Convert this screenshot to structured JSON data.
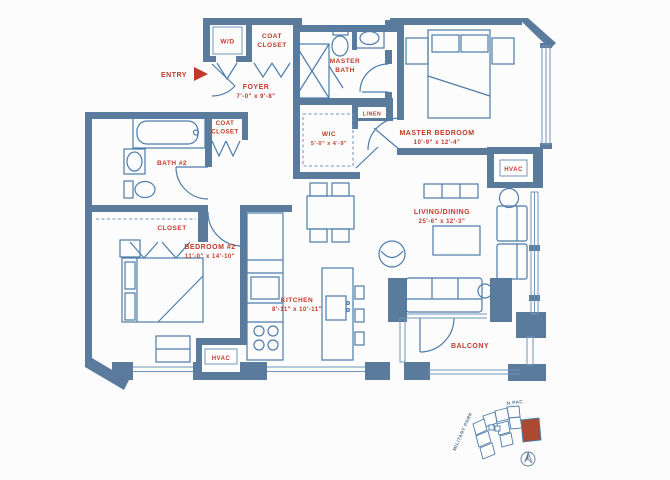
{
  "colors": {
    "wall": "#5b7b9c",
    "line": "#4d7caa",
    "label_red": "#c03a28",
    "highlight_unit": "#ab4a31",
    "background": "#fcfcfc"
  },
  "plan": {
    "wd": "W/D",
    "coat_closet_top": {
      "l1": "COAT",
      "l2": "CLOSET"
    },
    "entry": "ENTRY",
    "foyer": {
      "name": "FOYER",
      "dims": "7'-0\" x 9'-8\""
    },
    "master_bath": {
      "l1": "MASTER",
      "l2": "BATH"
    },
    "linen": "LINEN",
    "master_bedroom": {
      "name": "MASTER BEDROOM",
      "dims": "10'-9\" x 12'-4\""
    },
    "wic": {
      "name": "WIC",
      "dims": "5'-0\" x 4'-9\""
    },
    "coat_closet_mid": {
      "l1": "COAT",
      "l2": "CLOSET"
    },
    "bath_2": "BATH #2",
    "hvac_right": "HVAC",
    "closet": "CLOSET",
    "bedroom_2": {
      "name": "BEDROOM #2",
      "dims": "11'-0\" x 14'-10\""
    },
    "kitchen": {
      "name": "KITCHEN",
      "dims": "8'-11\" x 10'-11\""
    },
    "living_dining": {
      "name": "LIVING/DINING",
      "dims": "25'-6\" x 12'-3\""
    },
    "hvac_bottom": "HVAC",
    "balcony": "BALCONY"
  },
  "site_map": {
    "street_top": "N.PAC",
    "street_left": "MILITARY PARK"
  }
}
